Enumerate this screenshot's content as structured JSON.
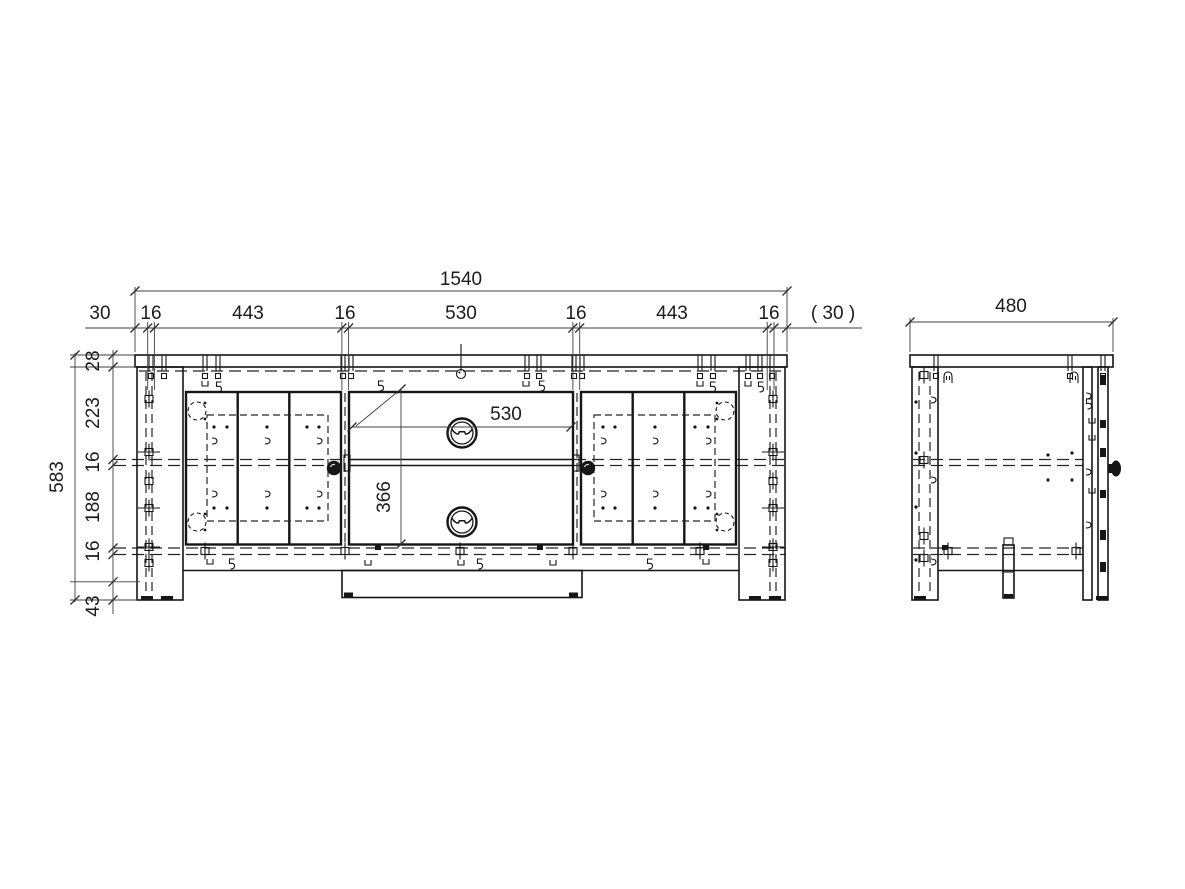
{
  "drawing": {
    "colors": {
      "background": "#ffffff",
      "line": "#161616",
      "dimension": "#3f3f3f"
    },
    "front_view": {
      "dim_overall_width": "1540",
      "dim_chain_top": [
        "30",
        "16",
        "443",
        "16",
        "530",
        "16",
        "443",
        "16",
        "( 30 )"
      ],
      "dim_overall_height": "583",
      "dim_chain_left": [
        "28",
        "223",
        "16",
        "188",
        "16",
        "43"
      ],
      "dim_niche_width": "530",
      "dim_niche_height": "366"
    },
    "side_view": {
      "dim_depth": "480"
    }
  }
}
